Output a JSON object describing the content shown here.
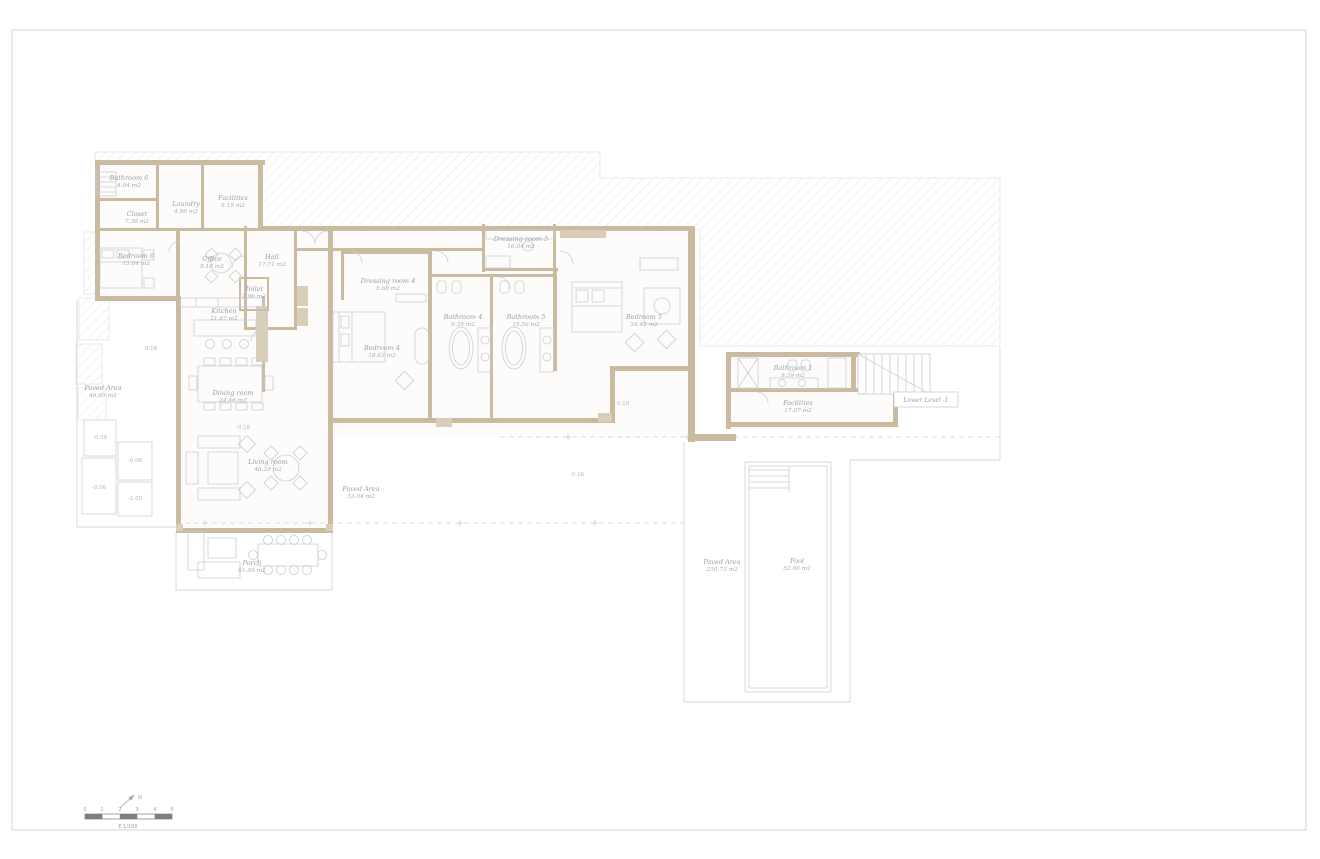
{
  "colors": {
    "wall": "#c9baa0",
    "wall_light": "#d9cfb8",
    "furniture_line": "#c9cdd4",
    "boundary_line": "#d4d6da",
    "hatch_line": "#dedede",
    "label_text": "#97a0ab",
    "frame": "#dcdcdc",
    "scale_dark": "#7a7e85"
  },
  "rooms": [
    {
      "name": "Bathroom 6",
      "area": "4.04 m2"
    },
    {
      "name": "Laundry",
      "area": "4.96 m2"
    },
    {
      "name": "Facilities",
      "area": "9.19 m2"
    },
    {
      "name": "Closet",
      "area": "7.36 m2"
    },
    {
      "name": "Bedroom 6",
      "area": "13.64 m2"
    },
    {
      "name": "Office",
      "area": "9.10 m2"
    },
    {
      "name": "Hall",
      "area": "17.71 m2"
    },
    {
      "name": "Toilet",
      "area": "2.96 m2"
    },
    {
      "name": "Kitchen",
      "area": "21.67 m2"
    },
    {
      "name": "Dining room",
      "area": "24.46 m2"
    },
    {
      "name": "Living room",
      "area": "46.29 m2"
    },
    {
      "name": "Dressing room 4",
      "area": "5.68 m2"
    },
    {
      "name": "Bedroom 4",
      "area": "18.63 m2"
    },
    {
      "name": "Bathroom 4",
      "area": "9.35 m2"
    },
    {
      "name": "Bathroom 5",
      "area": "15.56 m2"
    },
    {
      "name": "Dressing room 5",
      "area": "16.04 m2"
    },
    {
      "name": "Bedroom 5",
      "area": "34.45 m2"
    },
    {
      "name": "Bathroom 1",
      "area": "9.39 m2"
    },
    {
      "name": "Facilities",
      "area": "17.07 m2"
    },
    {
      "name": "Porch",
      "area": "61.09 m2"
    },
    {
      "name": "Paved Area",
      "area": "46.05 m2"
    },
    {
      "name": "Paved Area",
      "area": "53.04 m2"
    },
    {
      "name": "Paved Area",
      "area": "230.73 m2"
    },
    {
      "name": "Pool",
      "area": "52.00 m2"
    }
  ],
  "levels": [
    "-0.16",
    "-0.16",
    "-0.10",
    "-0.16",
    "-0.09",
    "-0.06",
    "-0.06",
    "-1.00"
  ],
  "annotations": {
    "lower_level": "Lower Level -1",
    "north_label": "N",
    "scale_label": "E 1/100",
    "scale_ticks": [
      "0",
      "1",
      "2",
      "3",
      "4",
      "5"
    ]
  }
}
